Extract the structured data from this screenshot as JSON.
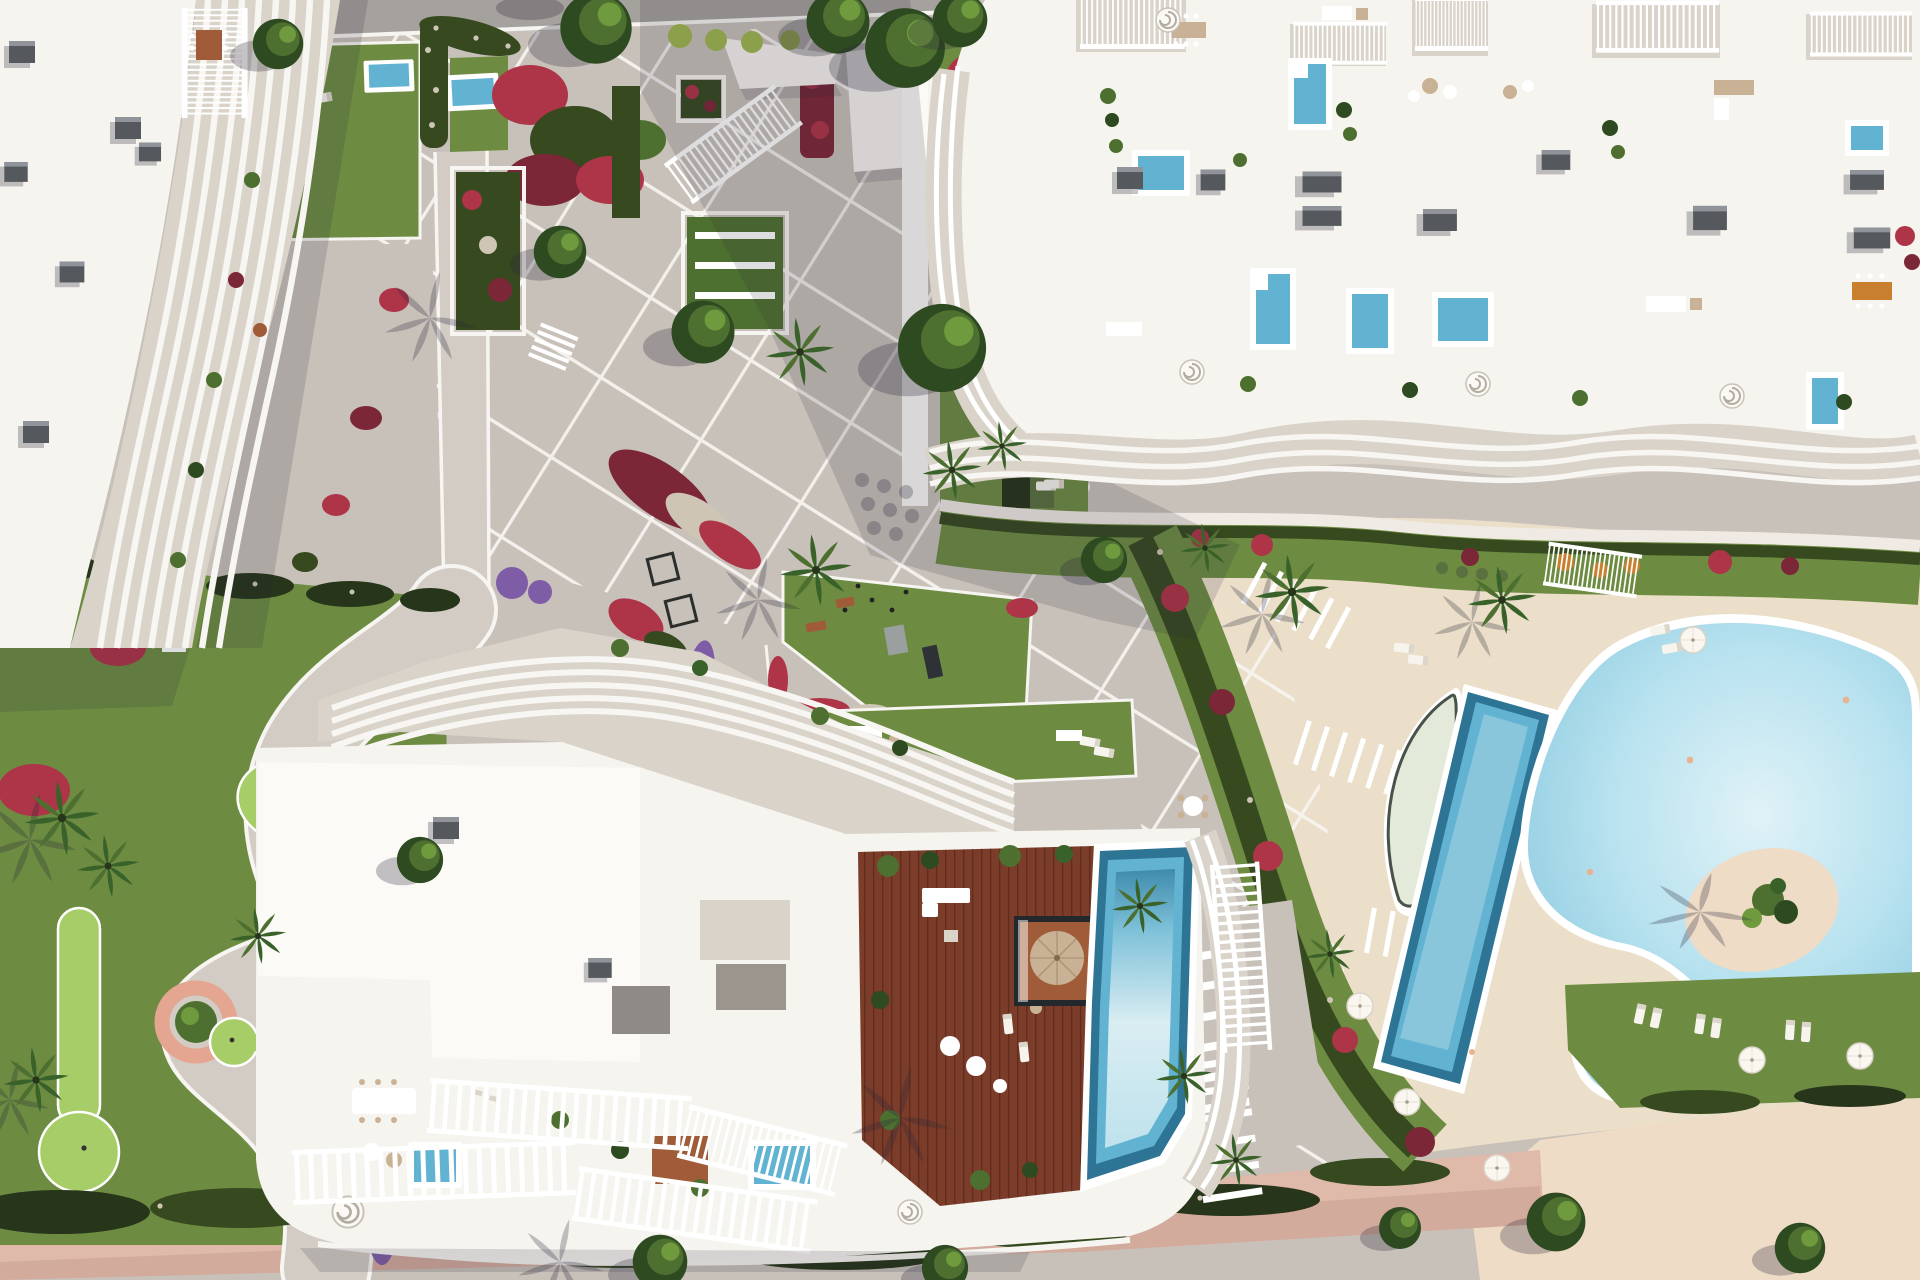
{
  "scene": {
    "title": "Aerial masterplan render of a coastal residential resort",
    "description": "Photorealistic top-down 3D architectural rendering of a beachfront apartment complex: three white sculptural buildings with wave-shaped balcony fins, rooftop terraces with plunge pools and lounge furniture, a diagonal paved plaza with white joint lines, landscaped gardens with red and purple flower beds, palm trees, an outdoor gym lawn, a mini-golf garden, a curved pool deck with a lap pool, a lens-shaped relaxation pool, a free-form lagoon pool with a planted sand island, a round kids pool, and a pink beach promenade along the bottom.",
    "view": "orthographic top-down, afternoon light from the north-east, long shadows cast to the south-west",
    "palette": {
      "paving": "#c8c1ba",
      "paving_light": "#d2ccc5",
      "paving_line": "#f7f5f1",
      "road": "#a5a19d",
      "deck_cream": "#ebdfca",
      "sand": "#eedcc6",
      "promenade": "#dfb9aa",
      "grass": "#6d8c42",
      "grass_dark": "#50702f",
      "grass_bright": "#a6cd68",
      "hedge": "#36491f",
      "hedge_dark": "#27351a",
      "tree_dark": "#2e4a21",
      "tree_mid": "#4d7030",
      "tree_light": "#6f9a3e",
      "palm": "#39622a",
      "lime_tree": "#8ca04c",
      "flower_red": "#ae3448",
      "flower_deep": "#7c2737",
      "flower_white": "#cfc5b4",
      "flower_purple": "#7e5da6",
      "flower_orange": "#c8802f",
      "planter_pink": "#e5a691",
      "roof": "#f6f4ef",
      "roof_bright": "#fbfaf6",
      "terrace": "#d9d3ca",
      "slat": "#ffffff",
      "skylight": "#55585c",
      "wood": "#7b3c2a",
      "wood_light": "#a05c39",
      "pool_blue": "#62b3d1",
      "pool_deep": "#2e7495",
      "pool_pale": "#cfe9ef",
      "pool_ice": "#e6f3f5",
      "lagoon": "#9cd4e6",
      "lagoon_light": "#dcf0f6",
      "lens": "#e4ead9",
      "kids": "#a9dae9",
      "teal": "#2fa8a0",
      "tan": "#c9b195",
      "shadow": "rgba(44,40,58,0.28)",
      "shadow_soft": "rgba(44,40,58,0.16)"
    },
    "areas": [
      {
        "name": "building-top-left",
        "label": "Apartment building with curved white balcony fins and rooftop skylights"
      },
      {
        "name": "building-top-right",
        "label": "Large apartment building with roof terraces, plunge pools and pergolas"
      },
      {
        "name": "building-bottom-center",
        "label": "Beachfront building with wavy pergola roof, wooden sun deck and rooftop pool"
      },
      {
        "name": "central-plaza",
        "label": "Diagonal paved plaza with white joint grid, planters and olive trees"
      },
      {
        "name": "fitness-lawn",
        "label": "Outdoor gym lawn with exercise mats and benches"
      },
      {
        "name": "sofa-lawn",
        "label": "Lounge lawn with outdoor sofas and games table"
      },
      {
        "name": "mini-golf-garden",
        "label": "Garden with putting greens, curved path and pink round planter"
      },
      {
        "name": "pool-deck",
        "label": "Curved cream pool deck with lens pool, lap pool, lagoon pool with sand island and kids pool"
      },
      {
        "name": "beach-promenade",
        "label": "Pink paved promenade and sandy beach strip"
      }
    ],
    "objects": {
      "rooftop_plunge_pools": 9,
      "large_pools": 4,
      "putting_greens": 3,
      "palm_trees": 14,
      "olive_trees": 7,
      "parasols": 7,
      "sun_loungers": 20,
      "spiral_staircases": 5
    }
  }
}
